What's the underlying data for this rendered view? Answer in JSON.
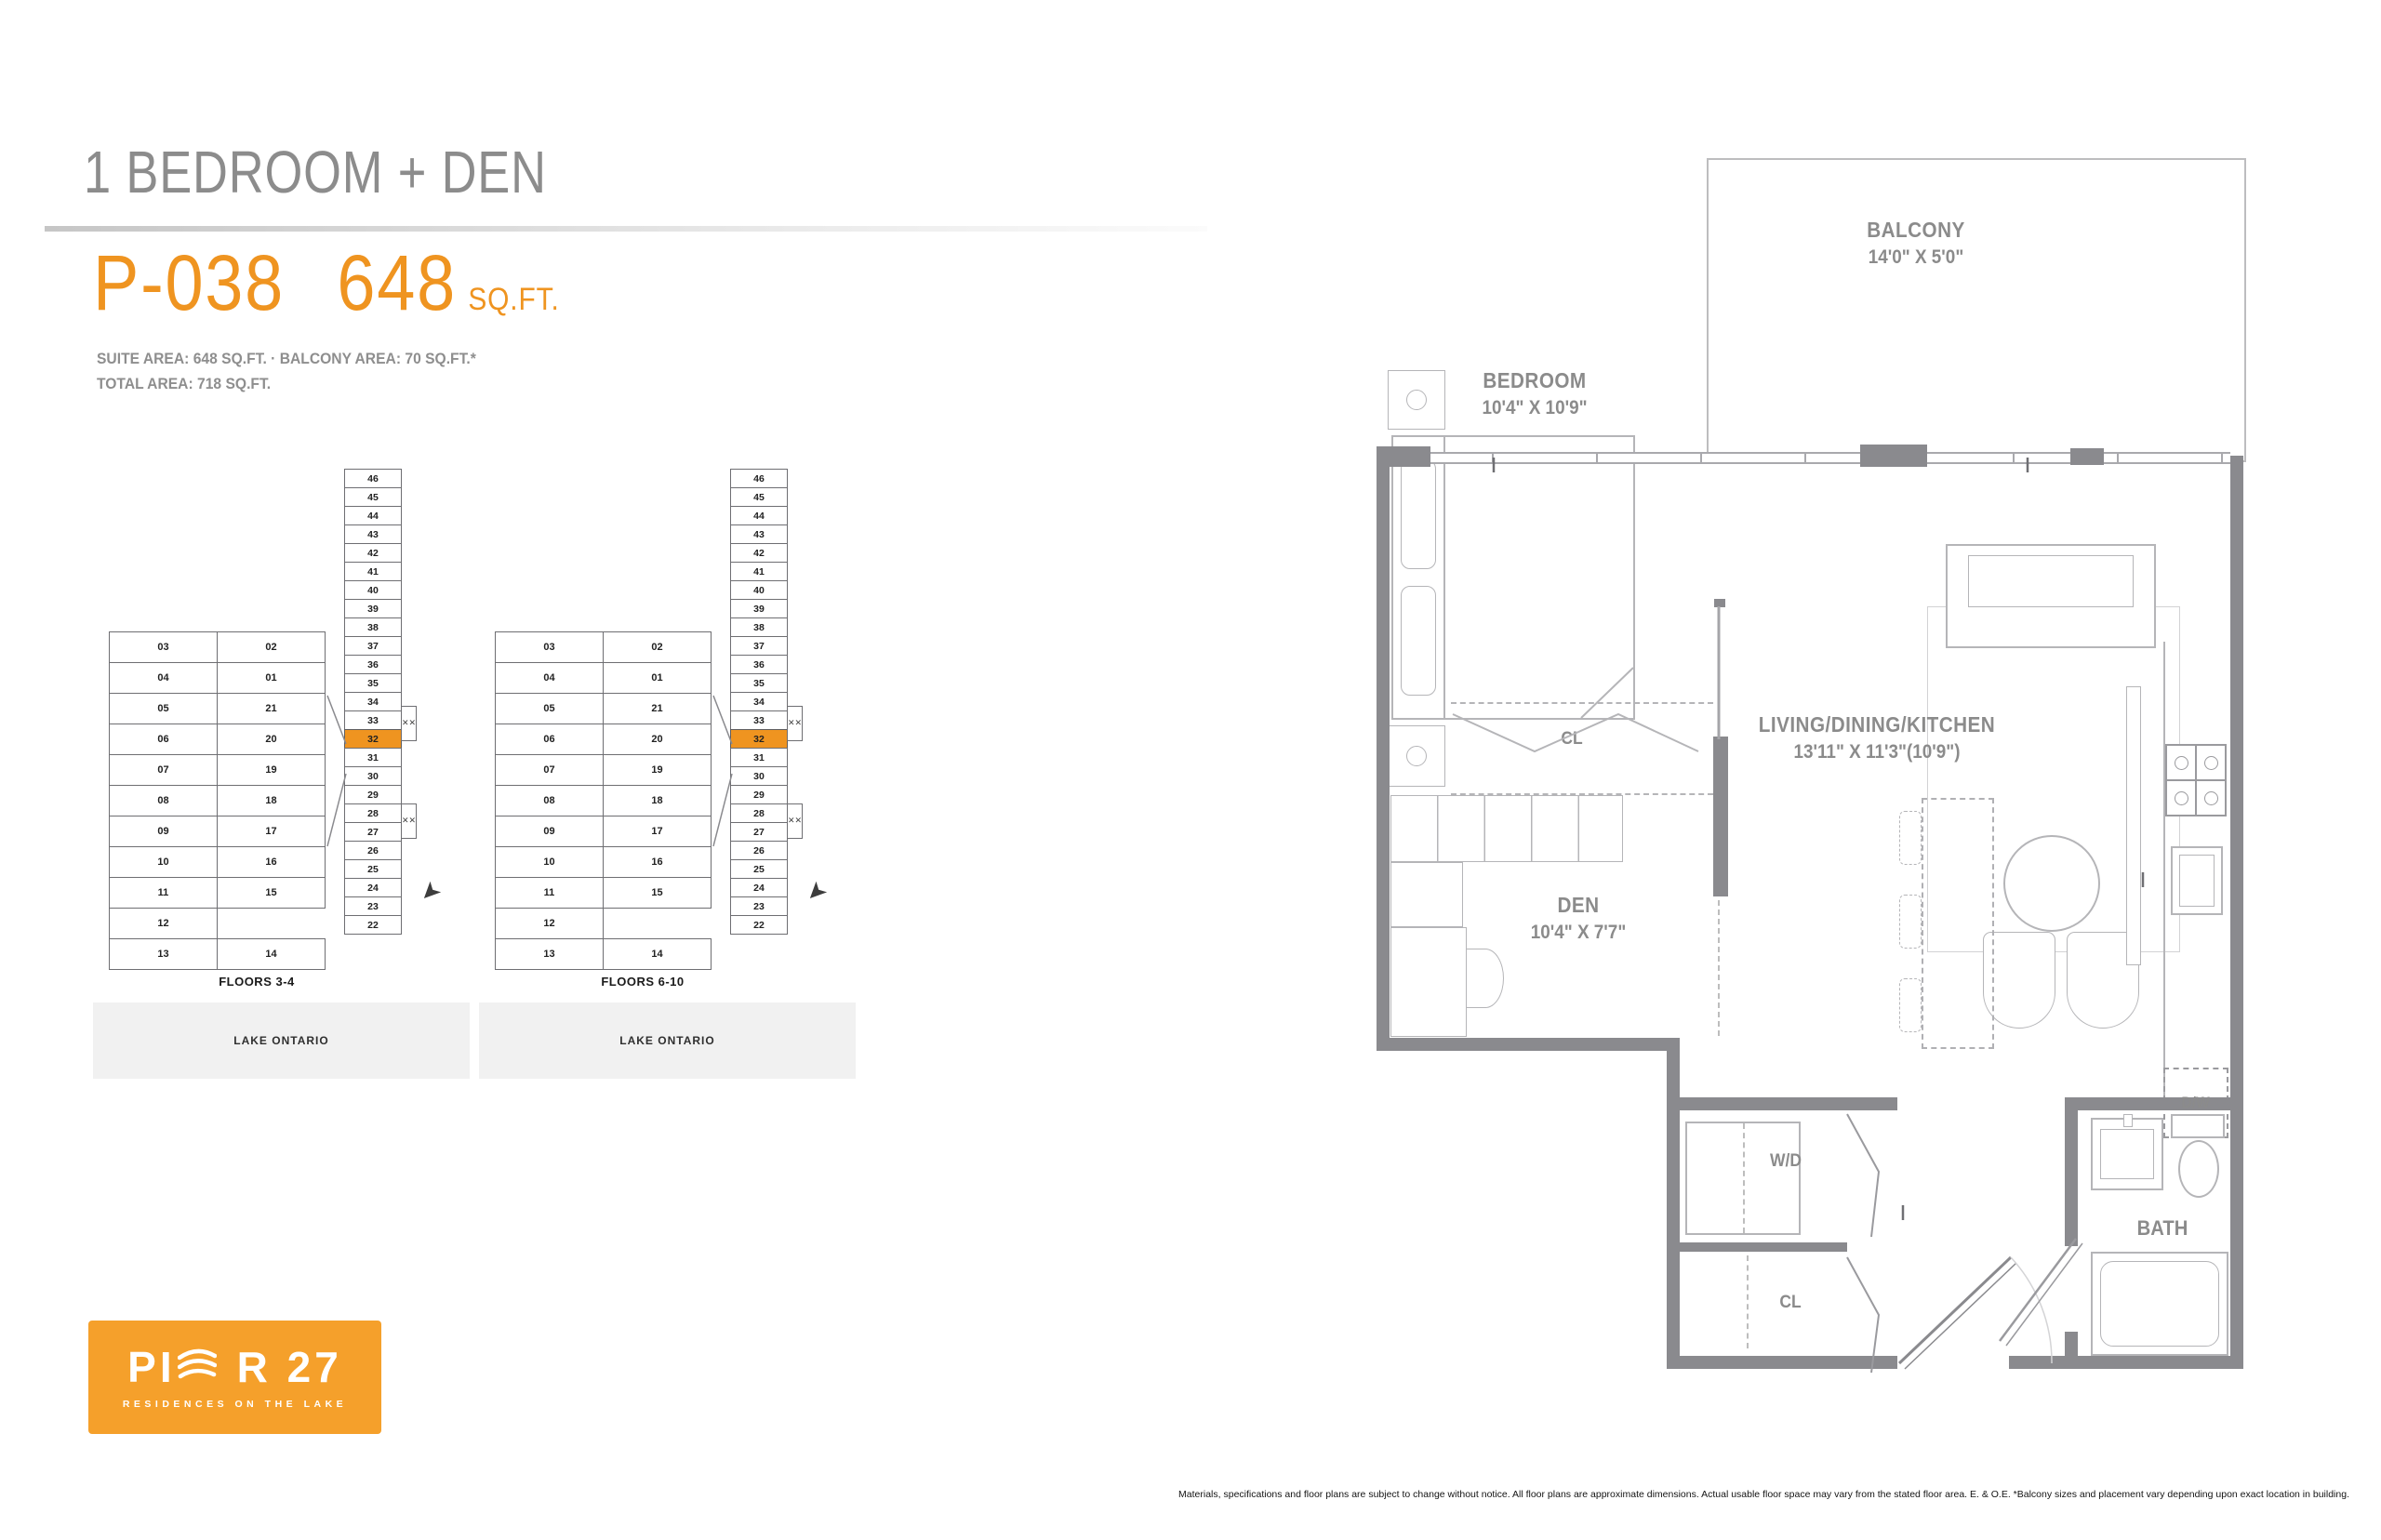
{
  "header": {
    "title": "1 BEDROOM + DEN",
    "unit_code": "P-038",
    "area_value": "648",
    "area_unit": "SQ.FT.",
    "suite_line": "SUITE AREA: 648 SQ.FT. · BALCONY AREA: 70 SQ.FT.*",
    "total_line": "TOTAL AREA: 718 SQ.FT."
  },
  "key_plans": [
    {
      "floors_label": "FLOORS 3-4",
      "water_label": "LAKE ONTARIO",
      "highlighted_unit": "32",
      "wing_rows": [
        [
          "03",
          "02"
        ],
        [
          "04",
          "01"
        ],
        [
          "05",
          "21"
        ],
        [
          "06",
          "20"
        ],
        [
          "07",
          "19"
        ],
        [
          "08",
          "18"
        ],
        [
          "09",
          "17"
        ],
        [
          "10",
          "16"
        ],
        [
          "11",
          "15"
        ],
        [
          "12",
          ""
        ],
        [
          "13",
          "14"
        ]
      ],
      "stack_units": [
        "46",
        "45",
        "44",
        "43",
        "42",
        "41",
        "40",
        "39",
        "38",
        "37",
        "36",
        "35",
        "34",
        "33",
        "32",
        "31",
        "30",
        "29",
        "28",
        "27",
        "26",
        "25",
        "24",
        "23",
        "22"
      ]
    },
    {
      "floors_label": "FLOORS 6-10",
      "water_label": "LAKE ONTARIO",
      "highlighted_unit": "32",
      "wing_rows": [
        [
          "03",
          "02"
        ],
        [
          "04",
          "01"
        ],
        [
          "05",
          "21"
        ],
        [
          "06",
          "20"
        ],
        [
          "07",
          "19"
        ],
        [
          "08",
          "18"
        ],
        [
          "09",
          "17"
        ],
        [
          "10",
          "16"
        ],
        [
          "11",
          "15"
        ],
        [
          "12",
          ""
        ],
        [
          "13",
          "14"
        ]
      ],
      "stack_units": [
        "46",
        "45",
        "44",
        "43",
        "42",
        "41",
        "40",
        "39",
        "38",
        "37",
        "36",
        "35",
        "34",
        "33",
        "32",
        "31",
        "30",
        "29",
        "28",
        "27",
        "26",
        "25",
        "24",
        "23",
        "22"
      ]
    }
  ],
  "floor_plan": {
    "balcony": {
      "name": "BALCONY",
      "dims": "14'0\" X 5'0\""
    },
    "bedroom": {
      "name": "BEDROOM",
      "dims": "10'4\" X 10'9\""
    },
    "living": {
      "name": "LIVING/DINING/KITCHEN",
      "dims": "13'11\" X 11'3\"(10'9\")"
    },
    "den": {
      "name": "DEN",
      "dims": "10'4\" X 7'7\""
    },
    "bath": {
      "name": "BATH"
    },
    "laundry": {
      "name": "W/D"
    },
    "closet_bedroom": {
      "name": "CL"
    },
    "closet_entry": {
      "name": "CL"
    },
    "dishwasher": {
      "name": "D/W"
    }
  },
  "logo": {
    "brand_prefix": "PI",
    "brand_suffix": "R 27",
    "tagline": "RESIDENCES ON THE LAKE"
  },
  "footer": {
    "disclaimer": "Materials, specifications and floor plans are subject to change without notice. All floor plans are approximate dimensions. Actual usable floor space may vary from the stated floor area.  E. & O.E.  *Balcony sizes and placement vary depending upon exact location in building."
  },
  "colors": {
    "accent_orange": "#EF9420",
    "logo_orange": "#F5A02B",
    "wall_gray": "#8A8A8E",
    "band_gray": "#F1F1F1",
    "text_gray": "#8C8C8C"
  }
}
